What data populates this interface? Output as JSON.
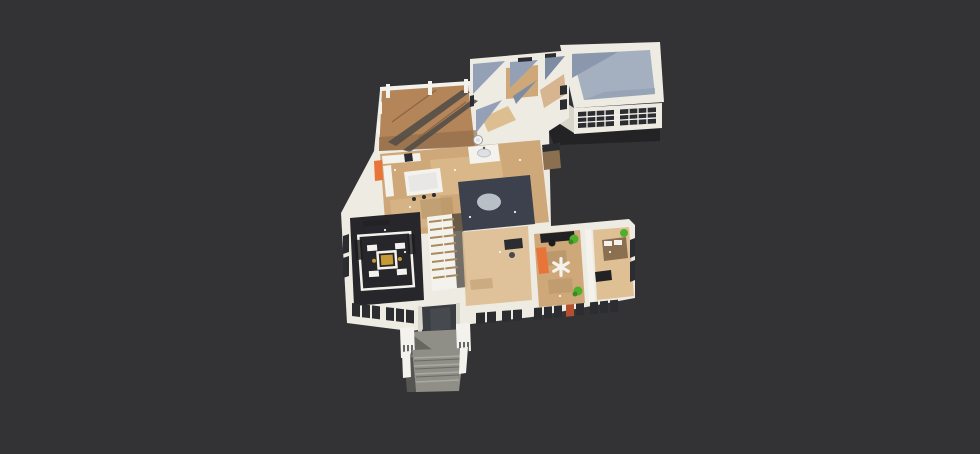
{
  "scene": {
    "type": "3d_floorplan_render",
    "view": "isometric_cutaway_dollhouse",
    "floors_visible": 1,
    "background": "#333336"
  },
  "colors": {
    "bg": "#333336",
    "wall": "#eeebe3",
    "wall_shade": "#d8d5cb",
    "wall_blue": "#93a0b6",
    "wall_blue_dark": "#7e8ca2",
    "deck_wood": "#b5855a",
    "deck_stripe": "#544e46",
    "deck_shadow": "#8f6c49",
    "floor_wood": "#cfa87a",
    "floor_wood_light": "#ddbe90",
    "floor_wood_dark": "#a98a5e",
    "garage_floor": "#a4b0c0",
    "garage_floor_shade": "#8a97ac",
    "panel_dark": "#2b2d30",
    "roof_dark": "#232326",
    "rug_dark": "#3c414d",
    "table_gray": "#b9bfc7",
    "media_floor": "#26262b",
    "gold": "#c79a36",
    "orange": "#e8743a",
    "green": "#4fae2d",
    "green_dark": "#3a8a20",
    "concrete": "#8f8f88",
    "concrete_light": "#a9a9a1",
    "concrete_shadow": "#5c5c57",
    "door_dark": "#3a3e42",
    "furn_dark": "#222225",
    "furn_wood": "#8a6f50",
    "white": "#f4f2ec",
    "window_glow": "#b4502e",
    "steel": "#dfe0e3"
  },
  "elements": [
    "wood-deck-with-pergola-shadows",
    "mudroom-bath-suite",
    "garage-with-paneled-door",
    "open-kitchen-with-island",
    "dining-round-table-on-rug",
    "interior-staircase",
    "media-room-white-sectional",
    "bedroom-with-ceiling-fan",
    "secondary-bedroom",
    "entry-porch-and-steps",
    "front-door",
    "facade-window-strips",
    "potted-plants",
    "orange-accent-panels",
    "exterior-chimney"
  ]
}
